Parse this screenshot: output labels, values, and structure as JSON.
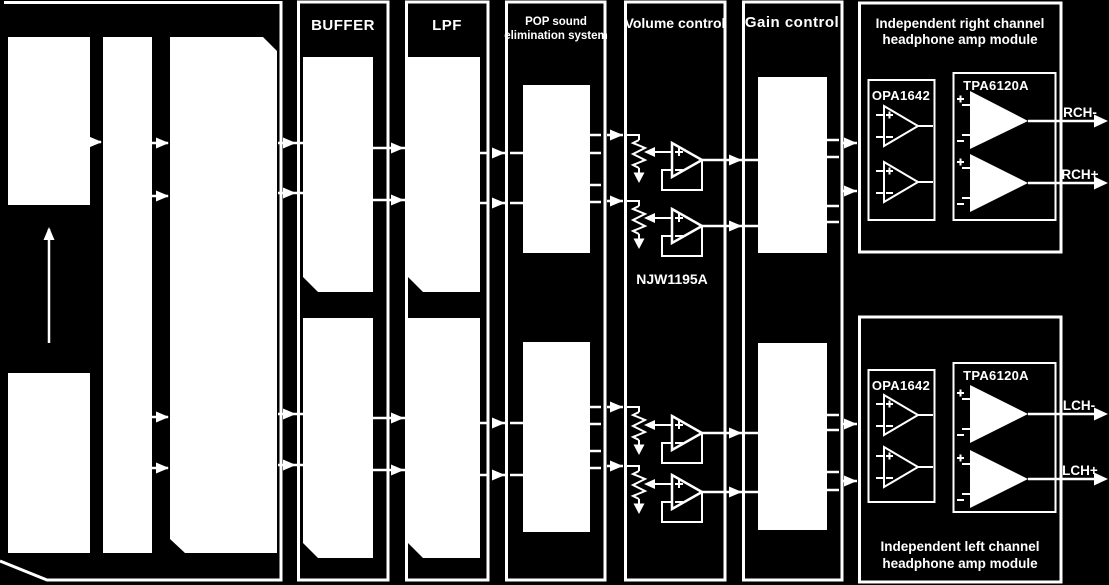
{
  "colors": {
    "background": "#000000",
    "foreground": "#ffffff"
  },
  "panels": {
    "buffer": {
      "label": "BUFFER"
    },
    "lpf": {
      "label": "LPF"
    },
    "pop": {
      "label_line1": "POP sound",
      "label_line2": "elimination system"
    },
    "volume": {
      "label": "Volume control",
      "chip": "NJW1195A"
    },
    "gain": {
      "label": "Gain control"
    }
  },
  "right_module": {
    "title_line1": "Independent right channel",
    "title_line2": "headphone amp module",
    "opamp_chip": "OPA1642",
    "amp_chip": "TPA6120A",
    "output_neg": "RCH-",
    "output_pos": "RCH+"
  },
  "left_module": {
    "title_line1": "Independent left channel",
    "title_line2": "headphone amp module",
    "opamp_chip": "OPA1642",
    "amp_chip": "TPA6120A",
    "output_neg": "LCH-",
    "output_pos": "LCH+"
  }
}
